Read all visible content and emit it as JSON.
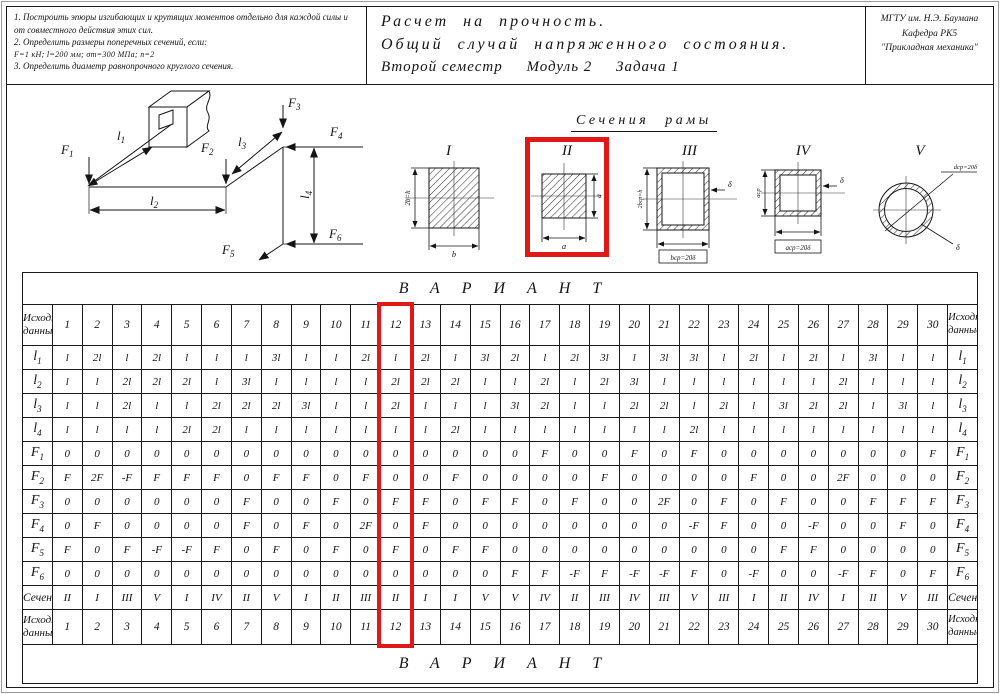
{
  "page": {
    "accent_red": "#e01818"
  },
  "header": {
    "tasks": [
      "1.  Построить эпюры изгибающих и крутящих моментов отдельно для каждой силы и от совместного действия этих сил.",
      "2.  Определить размеры поперечных сечений, если:",
      "F=1 кН;  l=200 мм;  σт=300 МПа;  n=2",
      "3.  Определить диаметр равнопрочного круглого сечения."
    ],
    "title_line1": "Расчет на прочность.",
    "title_line2": "Общий случай напряженного состояния.",
    "title_line3": "Второй семестр     Модуль 2     Задача 1",
    "org_line1": "МГТУ им. Н.Э. Баумана",
    "org_line2": "Кафедра РК5",
    "org_line3": "\"Прикладная механика\""
  },
  "frame_diagram": {
    "forces": [
      {
        "base": "F",
        "sub": "1"
      },
      {
        "base": "F",
        "sub": "2"
      },
      {
        "base": "F",
        "sub": "3"
      },
      {
        "base": "F",
        "sub": "4"
      },
      {
        "base": "F",
        "sub": "5"
      },
      {
        "base": "F",
        "sub": "6"
      }
    ],
    "lengths": [
      {
        "base": "l",
        "sub": "1"
      },
      {
        "base": "l",
        "sub": "2"
      },
      {
        "base": "l",
        "sub": "3"
      },
      {
        "base": "l",
        "sub": "4"
      }
    ]
  },
  "sections": {
    "title": "Сечения рамы",
    "highlighted_section": "II",
    "items": [
      {
        "numeral": "I",
        "left_dim": "2b=h",
        "bottom_dim": "b"
      },
      {
        "numeral": "II",
        "right_dim": "a",
        "bottom_dim": "a"
      },
      {
        "numeral": "III",
        "left_dim": "2bср=h",
        "thickness": "δ",
        "bottom_dim": "bср=20δ"
      },
      {
        "numeral": "IV",
        "left_dim": "aср",
        "thickness": "δ",
        "bottom_dim": "aср=20δ"
      },
      {
        "numeral": "V",
        "diameter_dim": "dср=20δ",
        "thickness": "δ"
      }
    ]
  },
  "table": {
    "variant_banner": "ВАРИАНТ",
    "corner_label": "Исходные данные",
    "highlighted_variant": 12,
    "variants": [
      1,
      2,
      3,
      4,
      5,
      6,
      7,
      8,
      9,
      10,
      11,
      12,
      13,
      14,
      15,
      16,
      17,
      18,
      19,
      20,
      21,
      22,
      23,
      24,
      25,
      26,
      27,
      28,
      29,
      30
    ],
    "rows": [
      {
        "base": "l",
        "sub": "1",
        "values": [
          "l",
          "2l",
          "l",
          "2l",
          "l",
          "l",
          "l",
          "3l",
          "l",
          "l",
          "2l",
          "l",
          "2l",
          "l",
          "3l",
          "2l",
          "l",
          "2l",
          "3l",
          "l",
          "3l",
          "3l",
          "l",
          "2l",
          "l",
          "2l",
          "l",
          "3l",
          "l",
          "l"
        ]
      },
      {
        "base": "l",
        "sub": "2",
        "values": [
          "l",
          "l",
          "2l",
          "2l",
          "2l",
          "l",
          "3l",
          "l",
          "l",
          "l",
          "l",
          "2l",
          "2l",
          "2l",
          "l",
          "l",
          "2l",
          "l",
          "2l",
          "3l",
          "l",
          "l",
          "l",
          "l",
          "l",
          "l",
          "2l",
          "l",
          "l",
          "l"
        ]
      },
      {
        "base": "l",
        "sub": "3",
        "values": [
          "l",
          "l",
          "2l",
          "l",
          "l",
          "2l",
          "2l",
          "2l",
          "3l",
          "l",
          "l",
          "2l",
          "l",
          "l",
          "l",
          "3l",
          "2l",
          "l",
          "l",
          "2l",
          "2l",
          "l",
          "2l",
          "l",
          "3l",
          "2l",
          "2l",
          "l",
          "3l",
          "l"
        ]
      },
      {
        "base": "l",
        "sub": "4",
        "values": [
          "l",
          "l",
          "l",
          "l",
          "2l",
          "2l",
          "l",
          "l",
          "l",
          "l",
          "l",
          "l",
          "l",
          "2l",
          "l",
          "l",
          "l",
          "l",
          "l",
          "l",
          "l",
          "2l",
          "l",
          "l",
          "l",
          "l",
          "l",
          "l",
          "l",
          "l"
        ]
      },
      {
        "base": "F",
        "sub": "1",
        "values": [
          "0",
          "0",
          "0",
          "0",
          "0",
          "0",
          "0",
          "0",
          "0",
          "0",
          "0",
          "0",
          "0",
          "0",
          "0",
          "0",
          "F",
          "0",
          "0",
          "F",
          "0",
          "F",
          "0",
          "0",
          "0",
          "0",
          "0",
          "0",
          "0",
          "F"
        ]
      },
      {
        "base": "F",
        "sub": "2",
        "values": [
          "F",
          "2F",
          "-F",
          "F",
          "F",
          "F",
          "0",
          "F",
          "F",
          "0",
          "F",
          "0",
          "0",
          "F",
          "0",
          "0",
          "0",
          "0",
          "F",
          "0",
          "0",
          "0",
          "0",
          "F",
          "0",
          "0",
          "2F",
          "0",
          "0",
          "0"
        ]
      },
      {
        "base": "F",
        "sub": "3",
        "values": [
          "0",
          "0",
          "0",
          "0",
          "0",
          "0",
          "F",
          "0",
          "0",
          "F",
          "0",
          "F",
          "F",
          "0",
          "F",
          "F",
          "0",
          "F",
          "0",
          "0",
          "2F",
          "0",
          "F",
          "0",
          "F",
          "0",
          "0",
          "F",
          "F",
          "F"
        ]
      },
      {
        "base": "F",
        "sub": "4",
        "values": [
          "0",
          "F",
          "0",
          "0",
          "0",
          "0",
          "F",
          "0",
          "F",
          "0",
          "2F",
          "0",
          "F",
          "0",
          "0",
          "0",
          "0",
          "0",
          "0",
          "0",
          "0",
          "-F",
          "F",
          "0",
          "0",
          "-F",
          "0",
          "0",
          "F",
          "0"
        ]
      },
      {
        "base": "F",
        "sub": "5",
        "values": [
          "F",
          "0",
          "F",
          "-F",
          "-F",
          "F",
          "0",
          "F",
          "0",
          "F",
          "0",
          "F",
          "0",
          "F",
          "F",
          "0",
          "0",
          "0",
          "0",
          "0",
          "0",
          "0",
          "0",
          "0",
          "F",
          "F",
          "0",
          "0",
          "0",
          "0"
        ]
      },
      {
        "base": "F",
        "sub": "6",
        "values": [
          "0",
          "0",
          "0",
          "0",
          "0",
          "0",
          "0",
          "0",
          "0",
          "0",
          "0",
          "0",
          "0",
          "0",
          "0",
          "F",
          "F",
          "-F",
          "F",
          "-F",
          "-F",
          "F",
          "0",
          "-F",
          "0",
          "0",
          "-F",
          "F",
          "0",
          "F"
        ]
      },
      {
        "label": "Сечение",
        "values": [
          "II",
          "I",
          "III",
          "V",
          "I",
          "IV",
          "II",
          "V",
          "I",
          "II",
          "III",
          "II",
          "I",
          "I",
          "V",
          "V",
          "IV",
          "II",
          "III",
          "IV",
          "III",
          "V",
          "III",
          "I",
          "II",
          "IV",
          "I",
          "II",
          "V",
          "III"
        ]
      }
    ]
  }
}
